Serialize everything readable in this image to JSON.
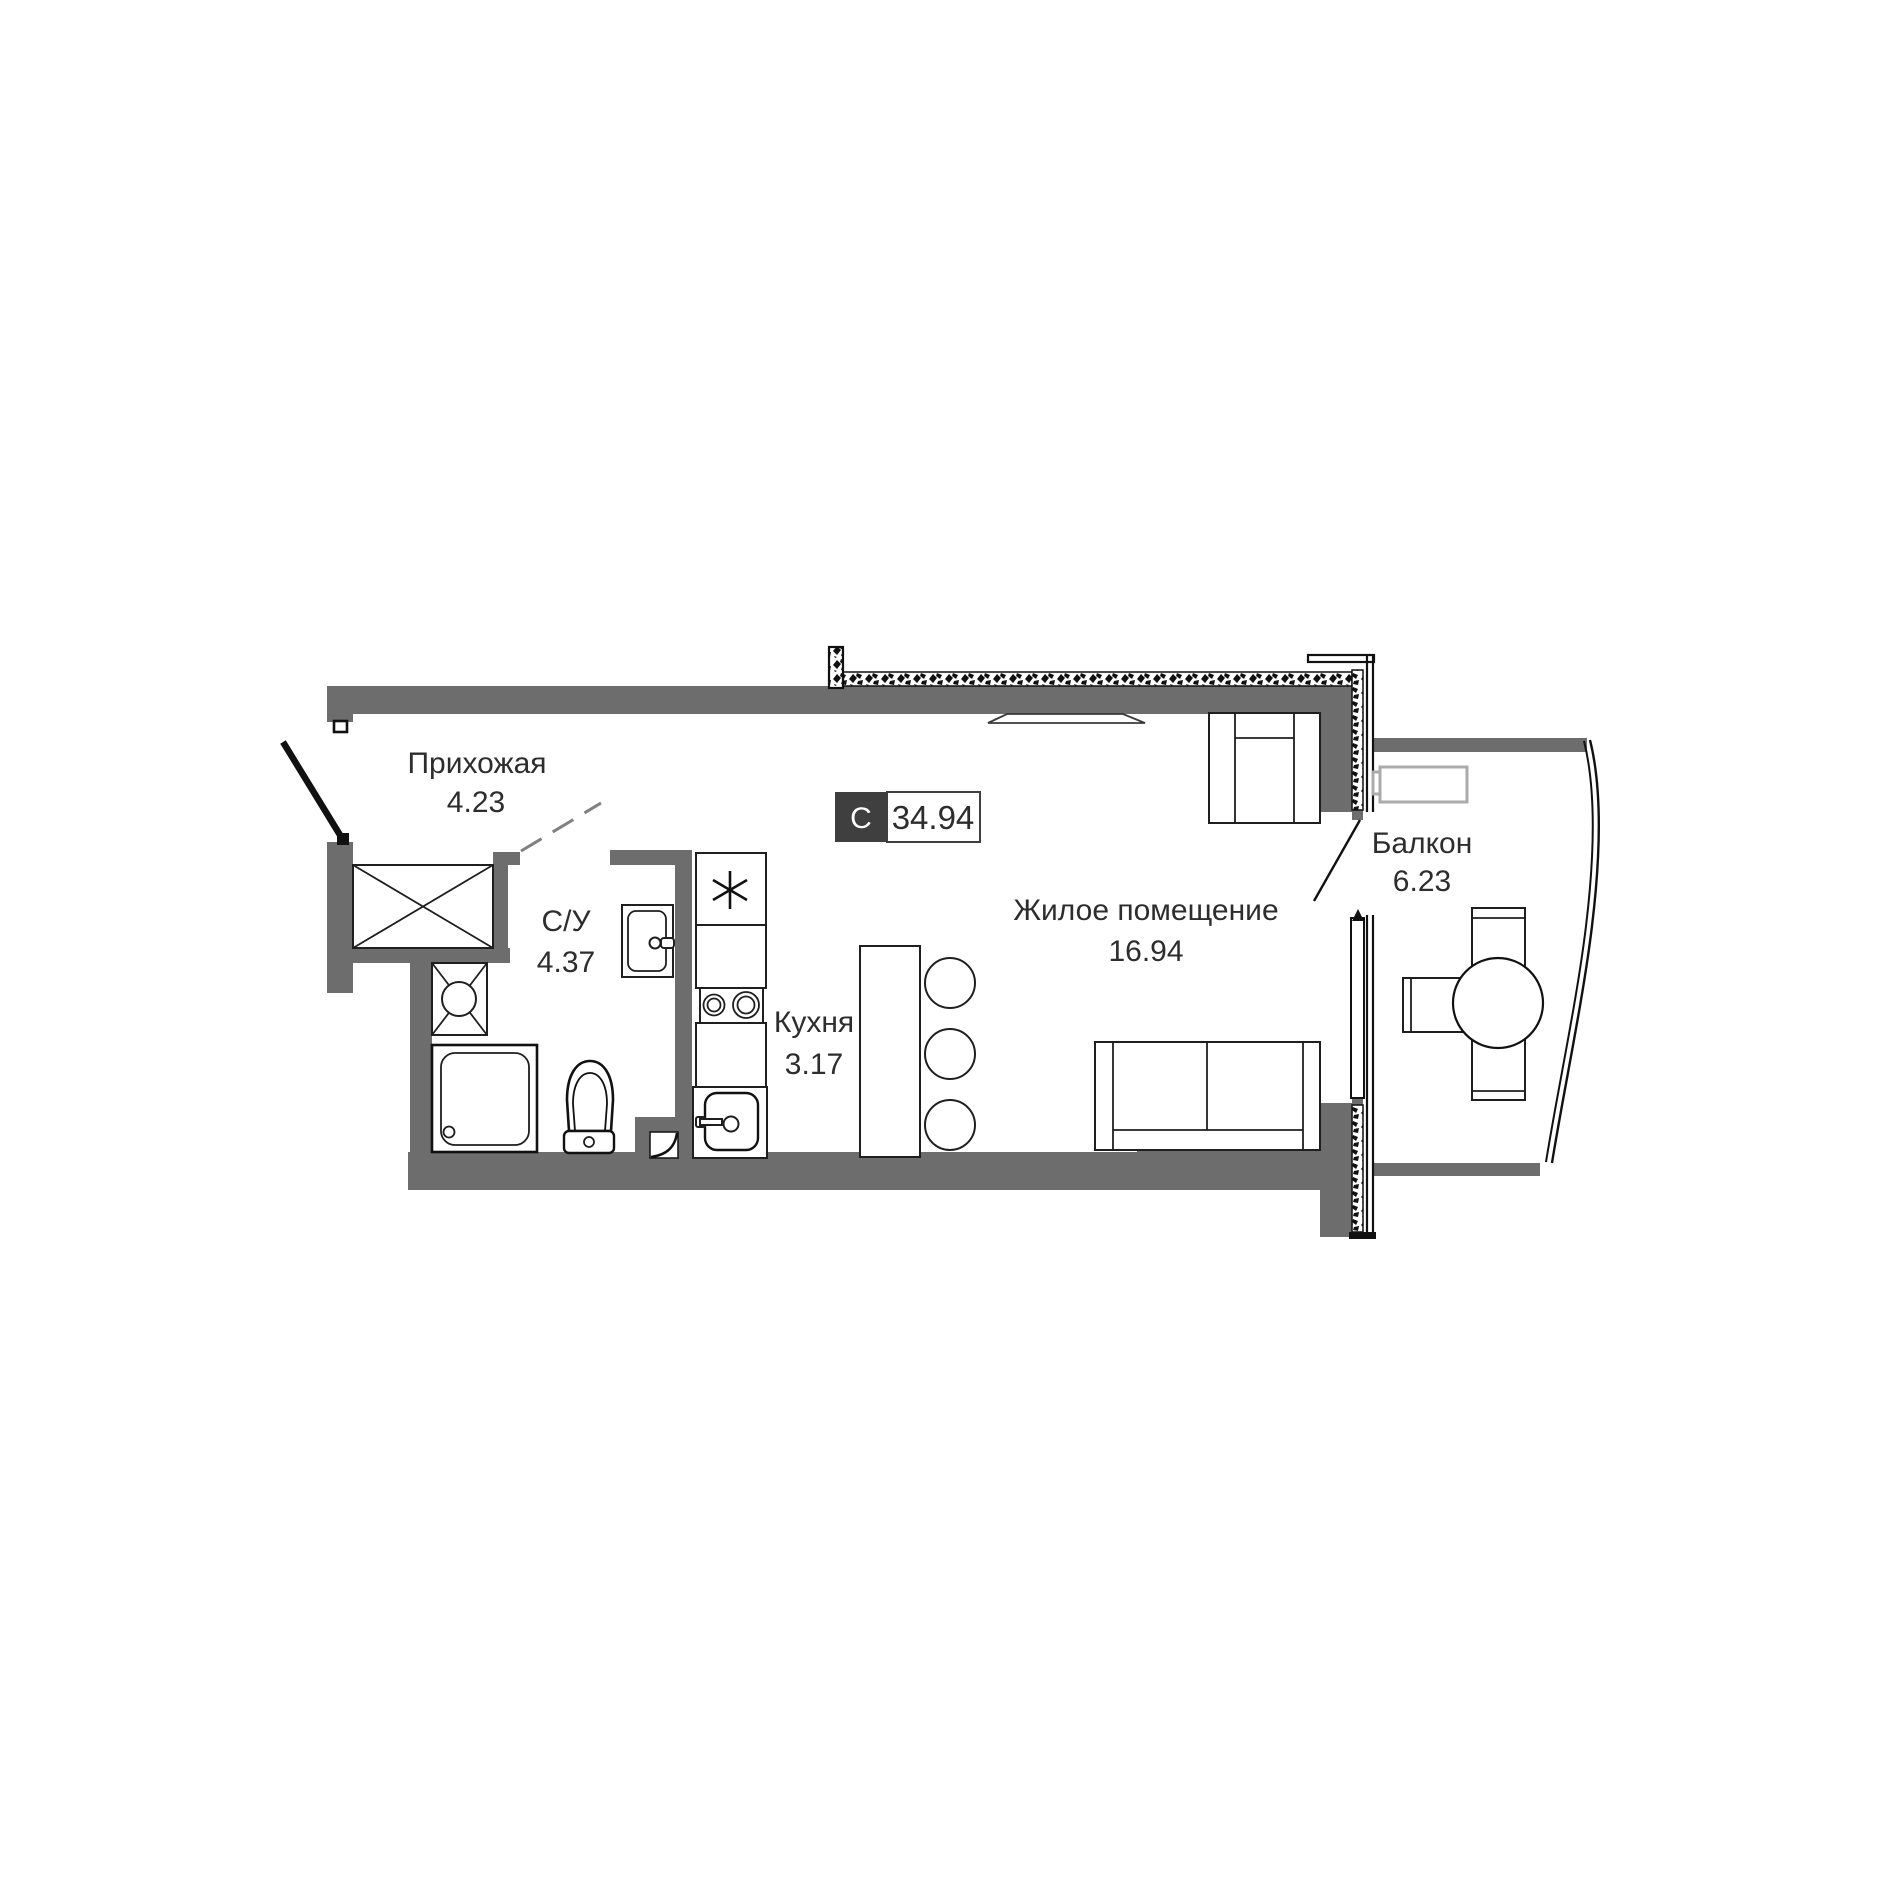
{
  "title": "Studio apartment floor plan",
  "badge": {
    "letter": "С",
    "total_area": "34.94"
  },
  "rooms": {
    "hallway": {
      "name": "Прихожая",
      "area": "4.23"
    },
    "bathroom": {
      "name": "С/У",
      "area": "4.37"
    },
    "kitchen": {
      "name": "Кухня",
      "area": "3.17"
    },
    "living": {
      "name": "Жилое помещение",
      "area": "16.94"
    },
    "balcony": {
      "name": "Балкон",
      "area": "6.23"
    }
  },
  "icons": {
    "fridge_symbol": "snowflake-asterisk"
  },
  "colors": {
    "wall": "#6d6d6d",
    "badge_dark": "#3f3f3f",
    "text": "#2d2d2d",
    "light_furniture": "#ababab",
    "background": "#ffffff"
  }
}
